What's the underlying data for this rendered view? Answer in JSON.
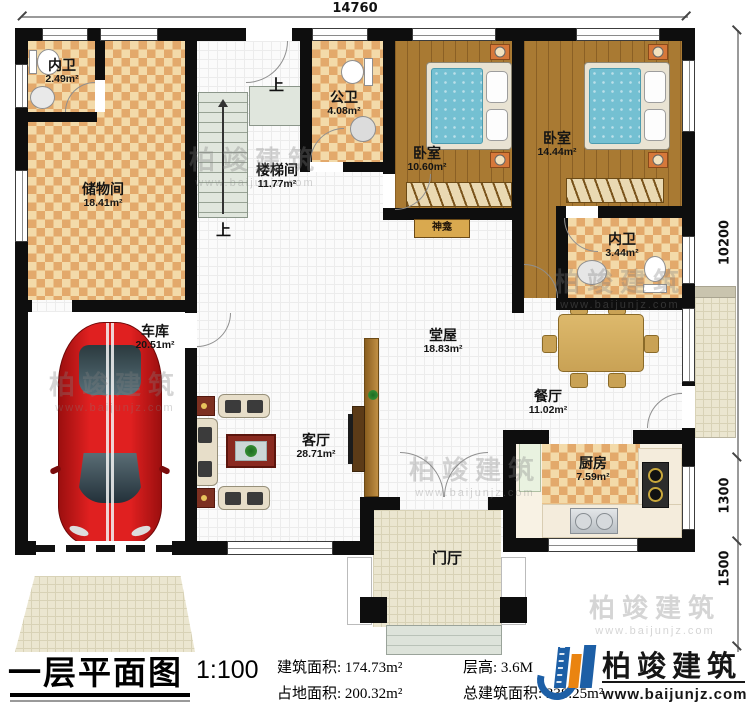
{
  "plan": {
    "rooms": [
      {
        "name": "内卫",
        "area": "2.49m²"
      },
      {
        "name": "储物间",
        "area": "18.41m²"
      },
      {
        "name": "楼梯间",
        "area": "11.77m²"
      },
      {
        "name": "公卫",
        "area": "4.08m²"
      },
      {
        "name": "卧室",
        "area": "10.60m²"
      },
      {
        "name": "卧室",
        "area": "14.44m²"
      },
      {
        "name": "内卫",
        "area": "3.44m²"
      },
      {
        "name": "堂屋",
        "area": "18.83m²"
      },
      {
        "name": "客厅",
        "area": "28.71m²"
      },
      {
        "name": "车库",
        "area": "20.51m²"
      },
      {
        "name": "餐厅",
        "area": "11.02m²"
      },
      {
        "name": "厨房",
        "area": "7.59m²"
      },
      {
        "name": "门厅",
        "area": ""
      }
    ],
    "annotations": {
      "shrine": "神龛",
      "stairs_up": "上"
    },
    "dimensions": {
      "top": "14760",
      "right_upper": "10200",
      "right_middle": "1300",
      "right_lower": "1500"
    }
  },
  "legend": {
    "title": "一层平面图",
    "scale": "1:100",
    "stats": [
      {
        "label": "建筑面积:",
        "value": "174.73m²"
      },
      {
        "label": "层高:",
        "value": "3.6M"
      },
      {
        "label": "占地面积:",
        "value": "200.32m²"
      },
      {
        "label": "总建筑面积:",
        "value": "338.25m²"
      }
    ],
    "logo": {
      "name": "柏竣建筑",
      "url": "www.baijunjz.com"
    }
  },
  "watermark": {
    "name": "柏竣建筑",
    "url": "www.baijunjz.com"
  }
}
